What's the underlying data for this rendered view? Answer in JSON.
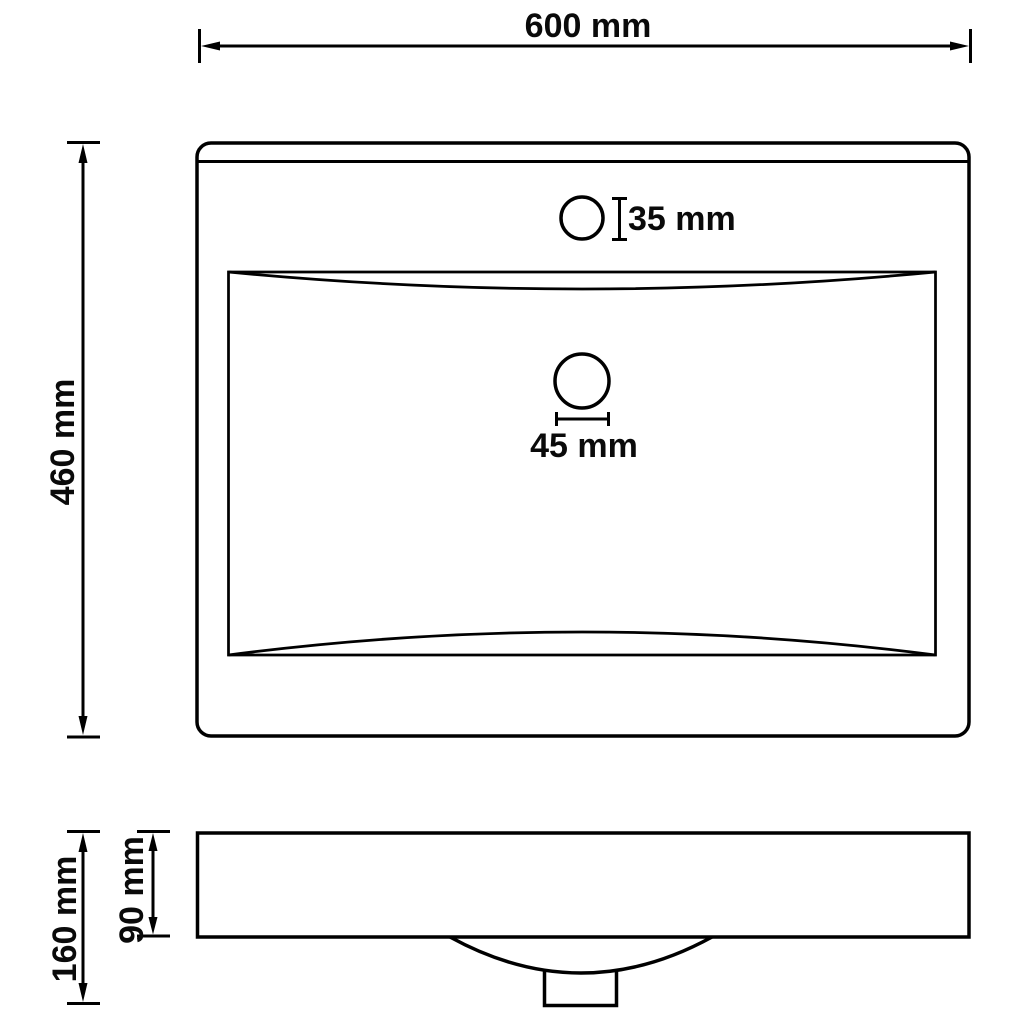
{
  "drawing": {
    "subject": "wash-basin-technical-drawing",
    "background_color": "#ffffff",
    "line_color": "#000000",
    "top_view": {
      "overall_width": "600 mm",
      "overall_depth": "460 mm",
      "faucet_hole_diameter": "35 mm",
      "drain_hole_diameter": "45 mm"
    },
    "side_view": {
      "overall_height": "160 mm",
      "basin_rim_height": "90 mm"
    }
  }
}
